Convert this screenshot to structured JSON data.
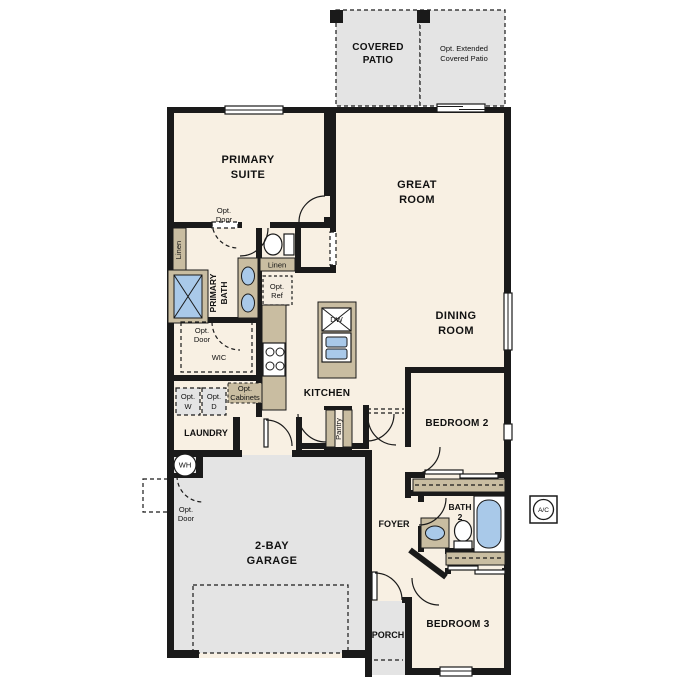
{
  "title": "Single-story floor plan",
  "labels": {
    "covered_patio": [
      "COVERED",
      "PATIO"
    ],
    "opt_extended_patio": [
      "Opt. Extended",
      "Covered Patio"
    ],
    "primary_suite": [
      "PRIMARY",
      "SUITE"
    ],
    "great_room": [
      "GREAT",
      "ROOM"
    ],
    "dining_room": [
      "DINING",
      "ROOM"
    ],
    "kitchen": "KITCHEN",
    "primary_bath": [
      "PRIMARY",
      "BATH"
    ],
    "wic": "WIC",
    "laundry": "LAUNDRY",
    "pantry": "Pantry",
    "garage": [
      "2-BAY",
      "GARAGE"
    ],
    "foyer": "FOYER",
    "porch": "PORCH",
    "bedroom2": "BEDROOM 2",
    "bath2": [
      "BATH",
      "2"
    ],
    "bedroom3": "BEDROOM 3",
    "linen_vertical": "Linen",
    "linen_horizontal": "Linen",
    "opt_door": [
      "Opt.",
      "Door"
    ],
    "opt_ref": [
      "Opt.",
      "Ref"
    ],
    "opt_washer": [
      "Opt.",
      "W"
    ],
    "opt_dryer": [
      "Opt.",
      "D"
    ],
    "opt_cabinets": [
      "Opt.",
      "Cabinets"
    ],
    "dishwasher": "DW",
    "water_heater": "WH",
    "ac_unit": "A/C"
  },
  "colors": {
    "wall": "#1a1a1a",
    "interior_floor": "#f8f0e3",
    "concrete_floor": "#e4e4e4",
    "cabinetry": "#c9bda1",
    "plumbing_fixture": "#a9c9e9",
    "background": "#ffffff"
  }
}
